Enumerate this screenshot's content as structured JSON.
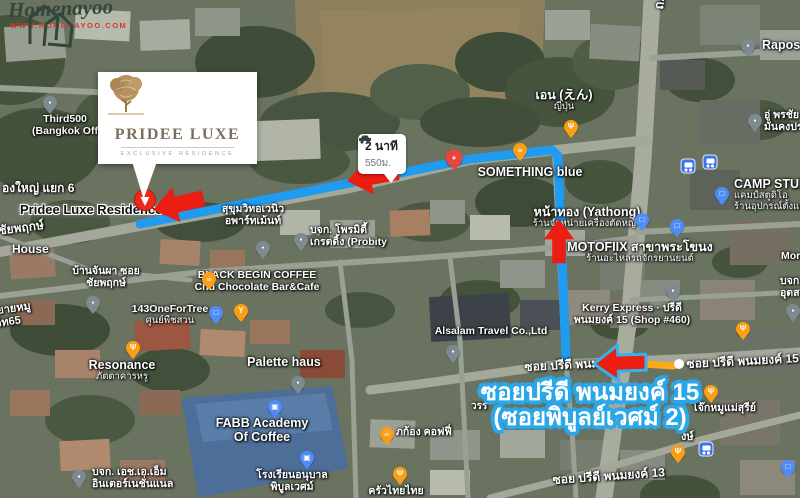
{
  "watermark": {
    "brand": "Homenayoo",
    "url": "WWW.HOMENAYOO.COM"
  },
  "logo_card": {
    "title": "PRIDEE LUXE",
    "subtitle": "EXCLUSIVE RESIDENCE"
  },
  "pill": {
    "duration": "2 นาที",
    "distance": "550ม."
  },
  "banner": {
    "line1": "ซอยปรีดี พนมยงค์ 15",
    "line2": "(ซอยพิบูลย์เวศม์ 2)",
    "stroke_color": "#2aa7e8"
  },
  "road_badge": {
    "label": "ซอย ปรีดี พนมยงค์ 15",
    "color": "#fbab18"
  },
  "colors": {
    "route_blue": "#1f9bef",
    "arrow_red": "#ec1d12",
    "pin_orange": "#fa9e14",
    "pin_blue": "#4e8cf7",
    "pin_gray": "#7d8a91",
    "pin_red": "#e8453c",
    "destination_pin": "#e8291c"
  },
  "pois": [
    {
      "id": "third500",
      "icon": "place-pin-icon",
      "type": "gray",
      "pin": {
        "x": 50,
        "y": 103
      },
      "label": {
        "x": 65,
        "y": 114,
        "align": "center",
        "lines": [
          "Third500",
          "(Bangkok Off"
        ]
      }
    },
    {
      "id": "rapos-group",
      "icon": "place-pin-icon",
      "type": "gray",
      "pin": {
        "x": 748,
        "y": 46
      },
      "label": {
        "x": 762,
        "y": 38,
        "align": "left",
        "lines": [
          "Rapos Group"
        ],
        "big": true
      }
    },
    {
      "id": "u-pornchai",
      "icon": "place-pin-icon",
      "type": "gray",
      "pin": {
        "x": 755,
        "y": 121
      },
      "label": {
        "x": 764,
        "y": 110,
        "align": "left",
        "lines": [
          "อู่ พรชัย",
          "มั่นคงปร"
        ]
      }
    },
    {
      "id": "en-japanese",
      "icon": "restaurant-pin-icon",
      "type": "restaurant",
      "pin": {
        "x": 571,
        "y": 127
      },
      "label": {
        "x": 564,
        "y": 88,
        "align": "center",
        "big": true,
        "lines": [
          "เอน (えん)"
        ],
        "sub": [
          "ญี่ปุ่น"
        ]
      }
    },
    {
      "id": "something-blue",
      "icon": "cafe-pin-icon",
      "type": "cafe",
      "pin": {
        "x": 520,
        "y": 150
      },
      "label": {
        "x": 530,
        "y": 165,
        "align": "center",
        "big": true,
        "lines": [
          "SOMETHING blue"
        ]
      }
    },
    {
      "id": "health-poi",
      "icon": "health-pin-icon",
      "type": "health",
      "pin": {
        "x": 454,
        "y": 158
      }
    },
    {
      "id": "yathong",
      "icon": "shopping-pin-icon",
      "type": "shopping",
      "pin": {
        "x": 642,
        "y": 220
      },
      "label": {
        "x": 587,
        "y": 205,
        "align": "center",
        "big": true,
        "lines": [
          "หน้าทอง (Yathong)"
        ],
        "sub": [
          "ร้านจำหน่ายเครื่องตัดหญ้า"
        ]
      }
    },
    {
      "id": "motofiix",
      "icon": "shopping-pin-icon",
      "type": "shopping",
      "pin": {
        "x": 677,
        "y": 226
      },
      "label": {
        "x": 640,
        "y": 240,
        "align": "center",
        "big": true,
        "lines": [
          "MOTOFIIX สาขาพระโขนง"
        ],
        "sub": [
          "ร้านอะไหล่รถจักรยานยนต์"
        ]
      }
    },
    {
      "id": "camp-studio",
      "icon": "shopping-pin-icon",
      "type": "shopping",
      "pin": {
        "x": 722,
        "y": 194
      },
      "label": {
        "x": 734,
        "y": 177,
        "align": "left",
        "big": true,
        "lines": [
          "CAMP STUDIO"
        ],
        "sub": [
          "แคมป์สตูดิโอ",
          "ร้านอุปกรณ์ตั้งแคมป์"
        ]
      }
    },
    {
      "id": "kerry-express",
      "icon": "place-pin-icon",
      "type": "gray",
      "pin": {
        "x": 673,
        "y": 291
      },
      "label": {
        "x": 632,
        "y": 303,
        "align": "center",
        "lines": [
          "Kerry Express · ปรีดี",
          "พนมยงค์ 15 (Shop #460)"
        ]
      }
    },
    {
      "id": "sukhumvit-avenue-apartment",
      "icon": "place-pin-icon",
      "type": "gray",
      "pin": {
        "x": 263,
        "y": 248
      },
      "label": {
        "x": 253,
        "y": 204,
        "align": "center",
        "lines": [
          "สุขุมวิทอเวนิว",
          "อพาร์ทเม้นท์"
        ]
      }
    },
    {
      "id": "probity",
      "icon": "place-pin-icon",
      "type": "gray",
      "pin": {
        "x": 301,
        "y": 240
      },
      "label": {
        "x": 310,
        "y": 225,
        "align": "left",
        "lines": [
          "บจก. โพรมิตี้",
          "เกรตดิ้ง (Probity"
        ]
      }
    },
    {
      "id": "black-begin-coffee",
      "icon": "cafe-pin-icon",
      "type": "cafe",
      "pin": {
        "x": 209,
        "y": 279
      },
      "label": {
        "x": 257,
        "y": 270,
        "align": "center",
        "lines": [
          "BLACK BEGIN COFFEE",
          "Chu Chocolate Bar&Cafe"
        ]
      }
    },
    {
      "id": "bar-poi",
      "icon": "bar-pin-icon",
      "type": "bar",
      "pin": {
        "x": 241,
        "y": 311
      }
    },
    {
      "id": "one-for-tree",
      "icon": "shopping-pin-icon",
      "type": "shopping",
      "pin": {
        "x": 216,
        "y": 313
      },
      "label": {
        "x": 170,
        "y": 304,
        "align": "center",
        "lines": [
          "143OneForTree"
        ],
        "sub": [
          "ศูนย์พืชสวน"
        ]
      }
    },
    {
      "id": "resonance",
      "icon": "restaurant-pin-icon",
      "type": "restaurant",
      "pin": {
        "x": 133,
        "y": 348
      },
      "label": {
        "x": 122,
        "y": 358,
        "align": "center",
        "big": true,
        "lines": [
          "Resonance"
        ],
        "sub": [
          "ภัตตาคารหรู"
        ]
      }
    },
    {
      "id": "baan-janpha",
      "icon": "place-pin-icon",
      "type": "gray",
      "pin": {
        "x": 93,
        "y": 303
      },
      "label": {
        "x": 106,
        "y": 266,
        "align": "center",
        "lines": [
          "บ้านจันผา ซอย",
          "ชัยพฤกษ์"
        ]
      }
    },
    {
      "id": "alsalam-travel",
      "icon": "place-pin-icon",
      "type": "gray",
      "pin": {
        "x": 453,
        "y": 352
      },
      "label": {
        "x": 491,
        "y": 326,
        "align": "center",
        "lines": [
          "Alsalam Travel Co.,Ltd"
        ]
      }
    },
    {
      "id": "palette-haus",
      "icon": "none",
      "type": "none",
      "label": {
        "x": 284,
        "y": 355,
        "align": "center",
        "big": true,
        "lines": [
          "Palette haus"
        ]
      }
    },
    {
      "id": "fabb-academy",
      "icon": "education-pin-icon",
      "type": "education",
      "pin": {
        "x": 275,
        "y": 407
      },
      "label": {
        "x": 262,
        "y": 416,
        "align": "center",
        "big": true,
        "lines": [
          "FABB Academy",
          "Of Coffee"
        ]
      }
    },
    {
      "id": "pibulwes-kindergarten",
      "icon": "education-pin-icon",
      "type": "education",
      "pin": {
        "x": 307,
        "y": 458
      },
      "label": {
        "x": 292,
        "y": 470,
        "align": "center",
        "lines": [
          "โรงเรียนอนุบาล",
          "พิบูลเวศม์"
        ]
      }
    },
    {
      "id": "pakong-coffee",
      "icon": "cafe-pin-icon",
      "type": "cafe",
      "pin": {
        "x": 387,
        "y": 434
      },
      "label": {
        "x": 396,
        "y": 427,
        "align": "left",
        "lines": [
          "ภก้อง คอฟฟี่"
        ]
      }
    },
    {
      "id": "krua-thai-thai",
      "icon": "restaurant-pin-icon",
      "type": "restaurant",
      "pin": {
        "x": 400,
        "y": 474
      },
      "label": {
        "x": 396,
        "y": 486,
        "align": "center",
        "lines": [
          "ครัวไทยไทย"
        ]
      }
    },
    {
      "id": "ham-international",
      "icon": "place-pin-icon",
      "type": "gray",
      "pin": {
        "x": 79,
        "y": 477
      },
      "label": {
        "x": 92,
        "y": 467,
        "align": "left",
        "lines": [
          "บจก. เอช.เอ.เอ็ม",
          "อินเตอร์เนชั่นแนล"
        ]
      }
    },
    {
      "id": "jok-moo-mae-suree",
      "icon": "restaurant-pin-icon",
      "type": "restaurant",
      "pin": {
        "x": 711,
        "y": 392
      },
      "label": {
        "x": 724,
        "y": 403,
        "align": "center",
        "lines": [
          "โจ๊กหมูแม่สุรีย์"
        ]
      }
    },
    {
      "id": "restaurant-poi-2",
      "icon": "restaurant-pin-icon",
      "type": "restaurant",
      "pin": {
        "x": 743,
        "y": 329
      }
    },
    {
      "id": "restaurant-poi-3",
      "icon": "restaurant-pin-icon",
      "type": "restaurant",
      "pin": {
        "x": 678,
        "y": 452
      }
    },
    {
      "id": "morn-poi",
      "icon": "place-pin-icon",
      "type": "gray",
      "pin": {
        "x": 793,
        "y": 311
      },
      "label": {
        "x": 781,
        "y": 251,
        "align": "left",
        "lines": [
          "Morn"
        ]
      }
    },
    {
      "id": "right-edge-company",
      "icon": "none",
      "type": "none",
      "label": {
        "x": 780,
        "y": 276,
        "align": "left",
        "lines": [
          "บจก.",
          "อุตสาห"
        ]
      }
    },
    {
      "id": "gray-poi-2",
      "icon": "place-pin-icon",
      "type": "gray",
      "pin": {
        "x": 298,
        "y": 383
      }
    },
    {
      "id": "shopping-poi-2",
      "icon": "shopping-pin-icon",
      "type": "shopping",
      "pin": {
        "x": 788,
        "y": 467
      }
    }
  ],
  "road_labels": [
    {
      "text": "ซอ",
      "x": 240,
      "y": 96,
      "rot": -8,
      "size": 11
    },
    {
      "text": "องใหญ่ แยก 6",
      "x": 2,
      "y": 179,
      "rot": 0,
      "size": 12
    },
    {
      "text": "ซ ชัยพฤกษ์",
      "x": -14,
      "y": 223,
      "rot": -7,
      "size": 12
    },
    {
      "text": "House",
      "x": 12,
      "y": 242,
      "rot": 0,
      "size": 12
    },
    {
      "text": "ยายหมู",
      "x": -4,
      "y": 301,
      "rot": -8,
      "size": 11
    },
    {
      "text": "วิท65",
      "x": -6,
      "y": 314,
      "rot": -8,
      "size": 11
    },
    {
      "text": "ถ. สุขุมวิท 71",
      "x": 648,
      "y": 8,
      "rot": -83,
      "size": 13
    },
    {
      "text": "ซอย ปรีดี พนม",
      "x": 524,
      "y": 358,
      "rot": -3,
      "size": 12
    },
    {
      "text": "ซอย ปรีดี พนมยงค์ 13",
      "x": 552,
      "y": 471,
      "rot": -4,
      "size": 12
    },
    {
      "text": "งษ์",
      "x": 681,
      "y": 427,
      "rot": 0,
      "size": 11
    },
    {
      "text": "วรร",
      "x": 471,
      "y": 399,
      "rot": 0,
      "size": 10
    }
  ],
  "badge_road_label": {
    "text": "ซอย ปรีดี พนมยงค์ 15",
    "x": 686,
    "y": 355,
    "rot": -3,
    "size": 12
  },
  "destination_label": {
    "text": "Pridee Luxe Residence C",
    "x": 20,
    "y": 203
  },
  "bus_stops": [
    {
      "x": 688,
      "y": 166
    },
    {
      "x": 710,
      "y": 162
    },
    {
      "x": 706,
      "y": 449
    }
  ],
  "icon_glyphs": {
    "cafe": "☕",
    "restaurant": "Ψ",
    "bar": "Y",
    "shopping": "□",
    "education": "▣",
    "gray": "●",
    "health": "+"
  }
}
